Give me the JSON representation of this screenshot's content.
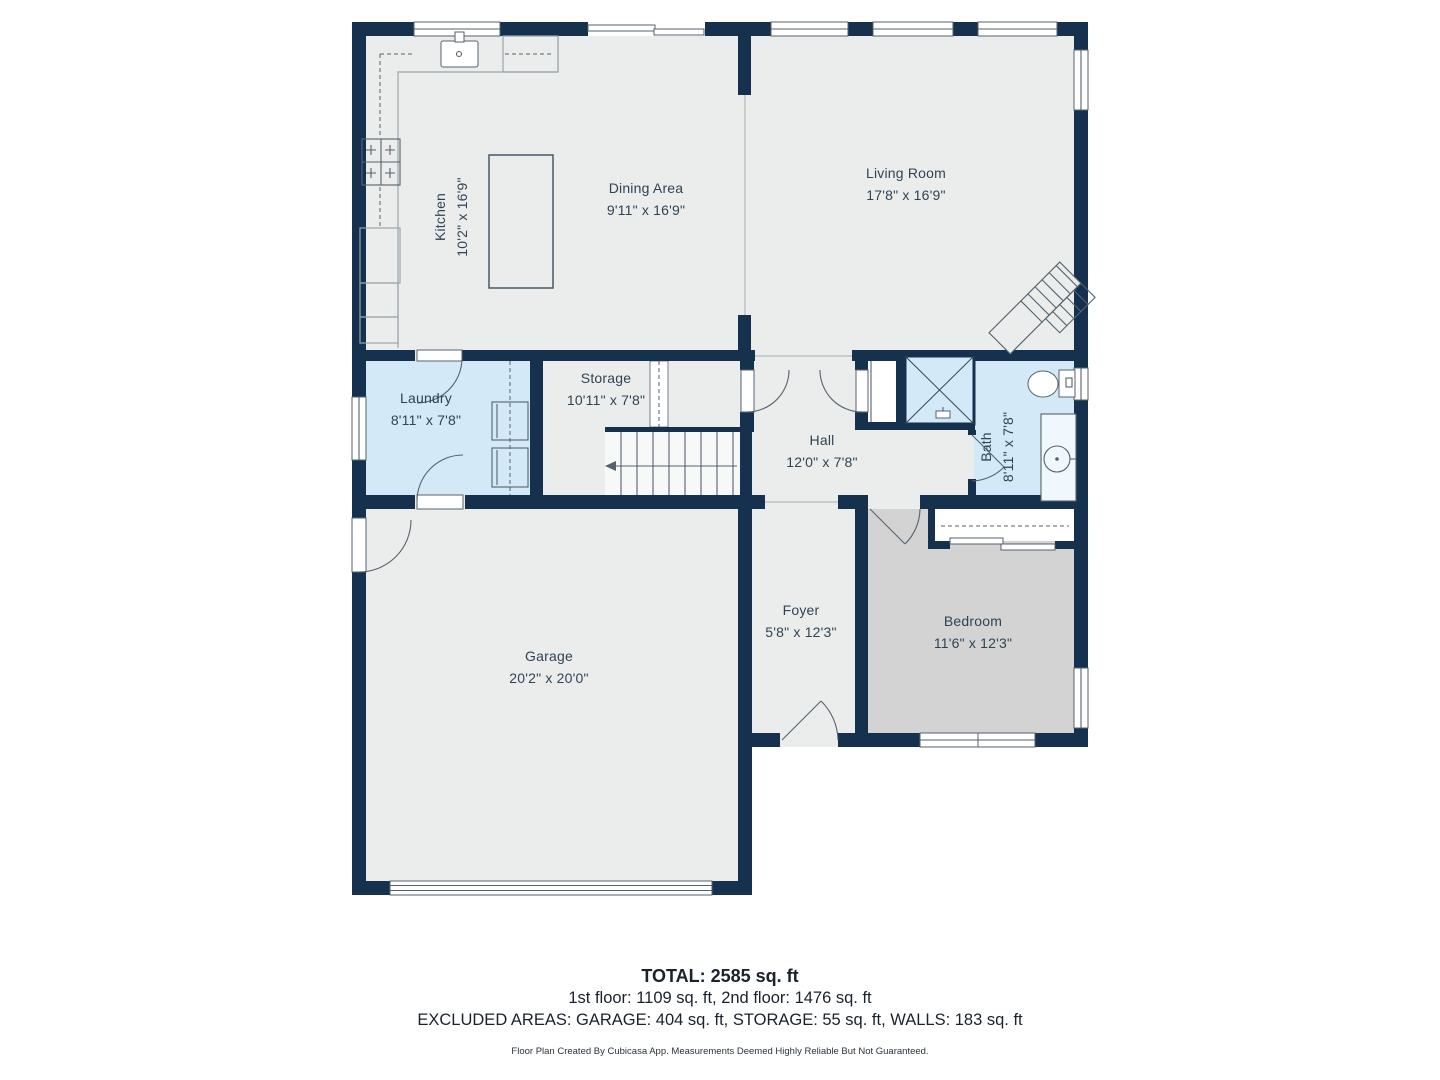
{
  "floor_plan": {
    "rooms": [
      {
        "name": "Kitchen",
        "dims": "10'2\" x 16'9\""
      },
      {
        "name": "Dining Area",
        "dims": "9'11\" x 16'9\""
      },
      {
        "name": "Living Room",
        "dims": "17'8\" x 16'9\""
      },
      {
        "name": "Laundry",
        "dims": "8'11\" x 7'8\""
      },
      {
        "name": "Storage",
        "dims": "10'11\" x 7'8\""
      },
      {
        "name": "Hall",
        "dims": "12'0\" x 7'8\""
      },
      {
        "name": "Bath",
        "dims": "8'11\" x 7'8\""
      },
      {
        "name": "Garage",
        "dims": "20'2\" x 20'0\""
      },
      {
        "name": "Foyer",
        "dims": "5'8\" x 12'3\""
      },
      {
        "name": "Bedroom",
        "dims": "11'6\" x 12'3\""
      }
    ],
    "summary": {
      "total": "TOTAL: 2585 sq. ft",
      "floors": "1st floor: 1109 sq. ft, 2nd floor: 1476 sq. ft",
      "excluded": "EXCLUDED AREAS: GARAGE: 404 sq. ft, STORAGE: 55 sq. ft, WALLS: 183 sq. ft",
      "disclaimer": "Floor Plan Created By Cubicasa App. Measurements Deemed Highly Reliable But Not Guaranteed."
    },
    "colors": {
      "wall": "#16314e",
      "floor": "#ebedec",
      "wet_room": "#d3e9f7",
      "bedroom_floor": "#d2d3d2",
      "fixture_line": "#55626e",
      "counter_line": "#9aa5ad",
      "open_line": "#b9c3ca",
      "label_text": "#2e4456",
      "footer_text": "#1a222c"
    },
    "icons": {
      "kitchen_sink": "sink-icon",
      "stove": "stove-icon",
      "refrigerator": "fridge-icon",
      "washer": "washer-icon",
      "dryer": "dryer-icon",
      "shower": "shower-icon",
      "toilet": "toilet-icon",
      "vanity_sink": "vanity-sink-icon",
      "stairs": "stairs-icon",
      "door": "door-arc-icon",
      "window": "window-icon",
      "garage_door": "garage-door-icon"
    }
  }
}
